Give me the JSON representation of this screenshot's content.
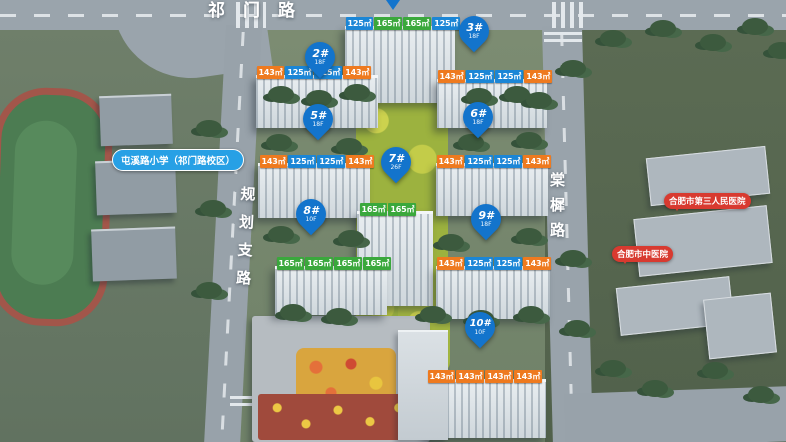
{
  "roads": {
    "top": "祁门路",
    "left": "规划支路",
    "right": "棠樨路"
  },
  "landmarks": {
    "school": "屯溪路小学（祁门路校区）",
    "hospital_top": "合肥市第三人民医院",
    "hospital_bottom": "合肥市中医院"
  },
  "buildings": [
    {
      "pin": "",
      "floors": "",
      "units": [
        "125㎡",
        "165㎡",
        "165㎡",
        "125㎡"
      ]
    },
    {
      "pin": "2#",
      "floors": "18F",
      "units": [
        "143㎡",
        "125㎡",
        "125㎡",
        "143㎡"
      ]
    },
    {
      "pin": "3#",
      "floors": "18F",
      "units": [
        "143㎡",
        "125㎡",
        "125㎡",
        "143㎡"
      ]
    },
    {
      "pin": "5#",
      "floors": "18F",
      "units": [
        "143㎡",
        "125㎡",
        "125㎡",
        "143㎡"
      ]
    },
    {
      "pin": "6#",
      "floors": "18F",
      "units": [
        "143㎡",
        "125㎡",
        "125㎡",
        "143㎡"
      ]
    },
    {
      "pin": "7#",
      "floors": "26F",
      "units": [
        "165㎡",
        "165㎡"
      ]
    },
    {
      "pin": "8#",
      "floors": "10F",
      "units": [
        "165㎡",
        "165㎡",
        "165㎡",
        "165㎡"
      ]
    },
    {
      "pin": "9#",
      "floors": "18F",
      "units": [
        "143㎡",
        "125㎡",
        "125㎡",
        "143㎡"
      ]
    },
    {
      "pin": "10#",
      "floors": "10F",
      "units": [
        "143㎡",
        "143㎡",
        "143㎡",
        "143㎡"
      ]
    }
  ],
  "colors": {
    "pin_blue": "#1374cc",
    "chip_orange": "#ee7a1f",
    "chip_blue": "#1b86d6",
    "chip_green": "#3aa83c",
    "school_label_blue": "#27a0e5",
    "hospital_label_red": "#d83a30"
  }
}
